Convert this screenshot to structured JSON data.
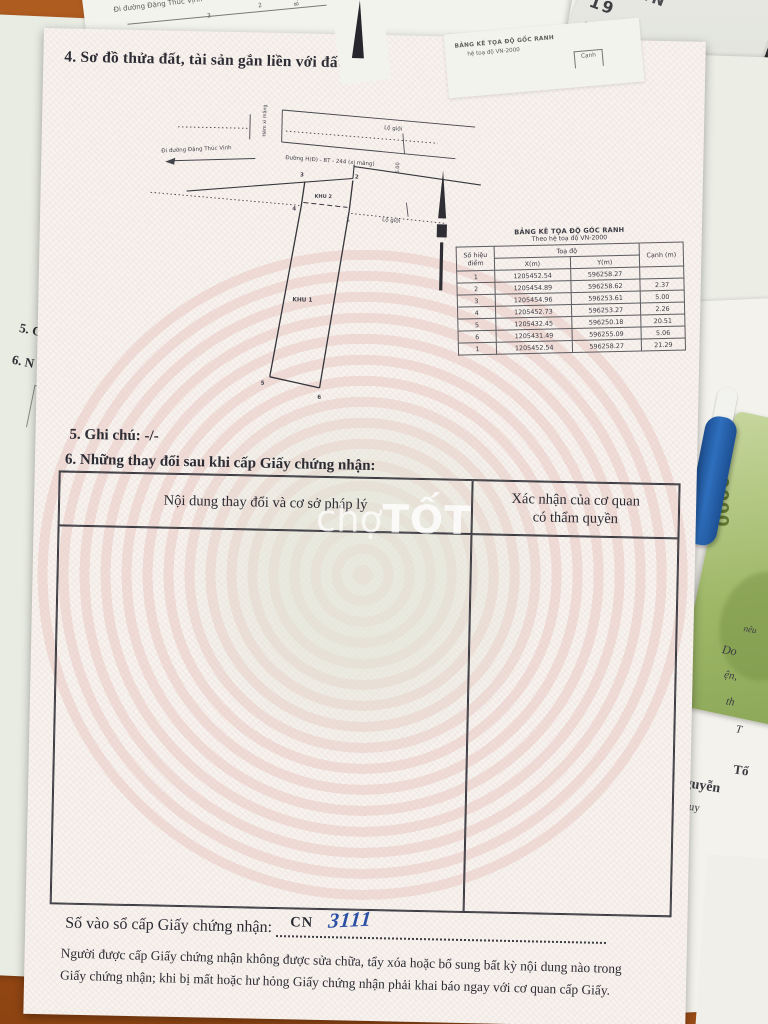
{
  "watermark": {
    "light": "chợ",
    "bold": "TỐT"
  },
  "doc": {
    "sections": {
      "s4_title": "4. Sơ đồ thửa đất, tài sản gắn liền với đất:",
      "s5_note": "5. Ghi chú: -/-",
      "s6_title": "6. Những thay đổi sau khi cấp Giấy chứng nhận:"
    },
    "diagram": {
      "street_left": "Đi đường Đặng Thúc Vịnh",
      "street_main": "Đường H(Đ) - BT - 244 (xi măng)",
      "alley": "Hẻm xi măng",
      "boundary_top": "Lộ giới",
      "boundary_mid": "Lộ giới",
      "zone1": "KHU 1",
      "zone2": "KHU 2",
      "dim": "6.00",
      "p1": "1",
      "p2": "2",
      "p3": "3",
      "p4": "4",
      "p5": "5",
      "p6": "6"
    },
    "coord_table": {
      "title": "BẢNG KÊ TỌA ĐỘ GÓC RANH",
      "subtitle": "Theo hệ toạ độ VN-2000",
      "h_point": "Số hiệu điểm",
      "h_coords": "Toạ độ",
      "h_x": "X(m)",
      "h_y": "Y(m)",
      "h_edge": "Cạnh (m)",
      "rows": [
        {
          "p": "1",
          "x": "1205452.54",
          "y": "596258.27",
          "e": ""
        },
        {
          "p": "2",
          "x": "1205454.89",
          "y": "596258.62",
          "e": "2.37"
        },
        {
          "p": "3",
          "x": "1205454.96",
          "y": "596253.61",
          "e": "5.00"
        },
        {
          "p": "4",
          "x": "1205452.73",
          "y": "596253.27",
          "e": "2.26"
        },
        {
          "p": "5",
          "x": "1205432.45",
          "y": "596250.18",
          "e": "20.51"
        },
        {
          "p": "6",
          "x": "1205431.49",
          "y": "596255.09",
          "e": "5.06"
        },
        {
          "p": "1",
          "x": "1205452.54",
          "y": "596258.27",
          "e": "21.29"
        }
      ]
    },
    "changes_table": {
      "h_content": "Nội dung thay đổi và cơ sở pháp lý",
      "h_authority1": "Xác nhận của cơ quan",
      "h_authority2": "có thẩm quyền"
    },
    "serial": {
      "label": "Số vào sổ cấp Giấy chứng nhận:",
      "prefix": "CN",
      "number": "3111"
    },
    "footer": {
      "line1": "Người được cấp Giấy chứng nhận không được sửa chữa, tẩy xóa hoặc bổ sung bất kỳ nội dung nào trong",
      "line2": "Giấy chứng nhận; khi bị mất hoặc hư hỏng Giấy chứng nhận phải khai báo ngay với cơ quan cấp Giấy."
    }
  },
  "surroundings": {
    "under_sheet": {
      "street_left": "Đi đường Đặng Thúc Vịnh",
      "street_main": "Đường H(Đ) - BT - 244 (xi măng)",
      "dim": "8.00",
      "p3": "3",
      "p2": "2",
      "table_title": "BẢNG KÊ TỌA ĐỘ GỐC RANH",
      "table_subtitle": "hệ toạ độ VN-2000",
      "table_col": "Cạnh",
      "s5_fragment": "5. G",
      "s6_fragment": "6. N"
    },
    "id_card": {
      "country": "CỘNG HÒA XÃ HỘI CHỦ NGHĨA VIỆT NAM",
      "title_fragment": "G DÂN",
      "number_fragment": "19",
      "details": [
        "9",
        "Việt Nam",
        "nh",
        "Ấp 7",
        "h"
      ]
    },
    "paper_fragments": [
      "nêu",
      "Do",
      "ện,",
      "th",
      "T",
      "Tổ",
      "guyễn",
      "o quy"
    ],
    "banknote_value": "100000"
  },
  "colors": {
    "table_surface": "#aa561c",
    "doc_paper": "#f6f2ee",
    "pattern_pink": "#e5beb8",
    "ink": "#2c2c34",
    "handwriting_blue": "#2b4fa3",
    "banknote_green": "#9fb868",
    "pen_blue": "#2e6fbd"
  }
}
